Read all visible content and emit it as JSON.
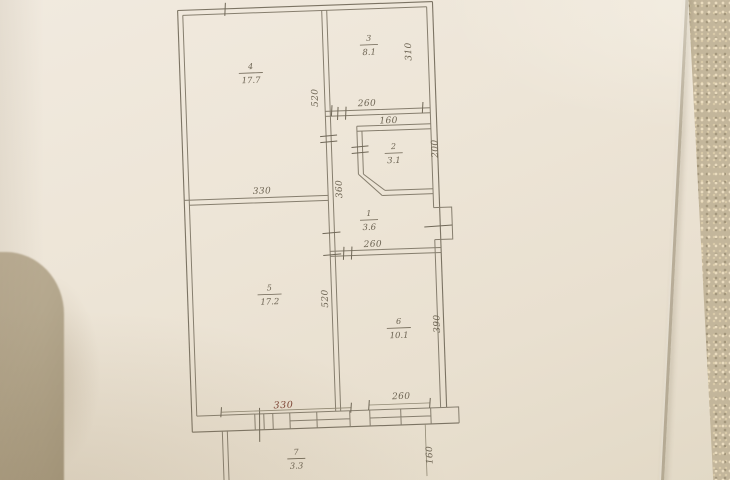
{
  "document_kind": "floor-plan-sketch-photo",
  "rooms": [
    {
      "number": "4",
      "area": "17.7"
    },
    {
      "number": "3",
      "area": "8.1"
    },
    {
      "number": "2",
      "area": "3.1"
    },
    {
      "number": "1",
      "area": "3.6"
    },
    {
      "number": "5",
      "area": "17.2"
    },
    {
      "number": "6",
      "area": "10.1"
    },
    {
      "number": "7",
      "area": "3.3"
    }
  ],
  "dimensions": {
    "room4_height": "520",
    "room4_width": "330",
    "room3_width": "260",
    "room3_height": "310",
    "room2_width": "160",
    "room2_height": "200",
    "hall_height": "360",
    "hall_width": "260",
    "room5_height": "520",
    "room5_width": "330",
    "room6_height": "390",
    "room6_width": "260",
    "balcony_height": "160"
  },
  "colors": {
    "paper": "#ece4d6",
    "ink": "#867e6e",
    "accent_red": "#7c4233",
    "background_fabric": "#c3b69b",
    "foreign_object": "#b2a58b"
  }
}
